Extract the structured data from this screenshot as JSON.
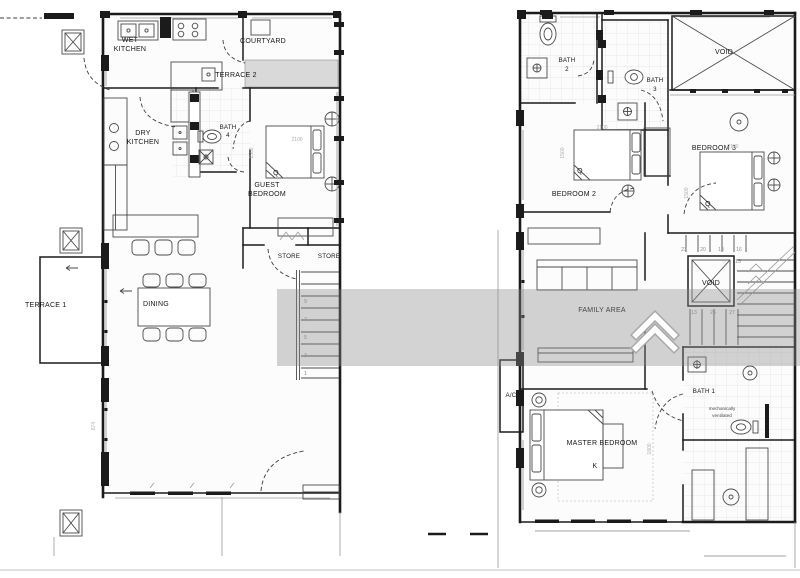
{
  "canvas": {
    "background": "#ffffff",
    "line_color": "#1b1b1b"
  },
  "watermark": {
    "logo_name": "double-chevron-roof-logo",
    "band_color": "#8c8c8c",
    "logo_color": "#ffffff"
  },
  "ground_floor": {
    "labels": {
      "wet_kitchen": [
        "WET",
        "KITCHEN"
      ],
      "courtyard": "COURTYARD",
      "terrace_2": "TERRACE 2",
      "dry_kitchen": [
        "DRY",
        "KITCHEN"
      ],
      "bath_4": [
        "BATH",
        "4"
      ],
      "guest_bedroom": [
        "GUEST",
        "BEDROOM"
      ],
      "guest_bed_size": "Q",
      "dining": "DINING",
      "terrace_1": "TERRACE 1",
      "store_left": "STORE",
      "store_right": "STORE"
    },
    "dimensions": {
      "terrace_height": "674",
      "guest_bed_width": "2100",
      "guest_bed_length": "1500"
    },
    "stair_treads": [
      "9",
      "7",
      "5",
      "3",
      "1"
    ]
  },
  "first_floor": {
    "labels": {
      "bath_2": [
        "BATH",
        "2"
      ],
      "bath_3": [
        "BATH",
        "3"
      ],
      "void_upper": "VOID",
      "bedroom_3": "BEDROOM 3",
      "bedroom_3_bed_size": "Q",
      "bedroom_2": "BEDROOM 2",
      "bedroom_2_bed_size": "Q",
      "family_area": "FAMILY AREA",
      "void_stair": "VOID",
      "ac_ledge": "A/C",
      "master_bedroom": "MASTER BEDROOM",
      "master_bed_size": "K",
      "bath_1": "BATH 1",
      "bath_1_note": [
        "mechanically",
        "ventilated"
      ]
    },
    "dimensions": {
      "bedroom_2_bed_width": "2100",
      "bedroom_2_bed_length": "1500",
      "bedroom_3_bed_width": "2100",
      "bedroom_3_bed_length": "1500",
      "master_bed_length": "1800"
    },
    "stair_treads_upper": [
      "23",
      "20",
      "18",
      "16",
      "15"
    ],
    "stair_treads_lower": [
      "13",
      "25",
      "27"
    ]
  }
}
